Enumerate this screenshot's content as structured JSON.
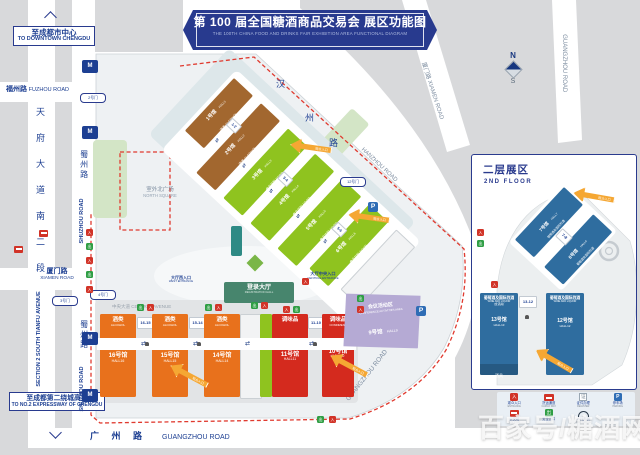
{
  "banner": {
    "zh": "第 100 届全国糖酒商品交易会 展区功能图",
    "en": "THE 100TH CHINA FOOD AND DRINKS FAIR  EXHIBITION AREA FUNCTIONAL DIAGRAM"
  },
  "signs": {
    "downtown_zh": "至成都市中心",
    "downtown_en": "TO DOWNTOWN CHENGDU",
    "expressway_zh": "至成都第二绕城高速",
    "expressway_en": "TO NO.2 EXPRESSWAY OF CHENGDU"
  },
  "roads": {
    "fuzhou_zh": "福州路",
    "fuzhou_en": "FUZHOU ROAD",
    "tianfu_chars": [
      "天",
      "府",
      "大",
      "道",
      "南",
      "二",
      "段"
    ],
    "tianfu_en": "SECTION 2 SOUTH TIANFU AVENUE",
    "shuzhou_zh": "蜀州路",
    "shuzhou_en": "SHUZHOU ROAD",
    "xiamen_zh": "厦门路",
    "xiamen_en": "XIAMEN ROAD",
    "hanzhou_chars": [
      "汉",
      "州",
      "路"
    ],
    "hanzhou_en": "HANZHOU ROAD",
    "guangzhou_zh": "广 州 路",
    "guangzhou_en": "GUANGZHOU ROAD",
    "central_avenue": "中央大道 CENTRAL AVENUE"
  },
  "places": {
    "north_square_zh": "室外北广场",
    "north_square_en": "NORTH SQUARE",
    "registration_zh": "登录大厅",
    "registration_en": "REGISTRATION HALL",
    "central_entrance_zh": "大厅中央入口",
    "central_entrance_en": "CENTRAL ENTRANCE",
    "west_entrance_zh": "大厅西入口",
    "west_entrance_en": "WEST ENTRANCE"
  },
  "gates": [
    "2号门",
    "3号门",
    "4号门",
    "12号门"
  ],
  "arrow_label": "观众入口",
  "compass": {
    "n": "N",
    "s": "S"
  },
  "halls_upper": [
    {
      "zh": "1号馆",
      "en": "HALL1",
      "cat": "酒类 ALCOHOL"
    },
    {
      "zh": "2号馆",
      "en": "HALL2",
      "cat": "酒类 ALCOHOL"
    },
    {
      "zh": "3号馆",
      "en": "HALL3",
      "cat": "食品饮料 FOOD"
    },
    {
      "zh": "4号馆",
      "en": "HALL4",
      "cat": "食品饮料 FOOD"
    },
    {
      "zh": "5号馆",
      "en": "HALL5",
      "cat": "食品饮料 FOOD"
    },
    {
      "zh": "6号馆",
      "en": "HALL6",
      "cat": "食品饮料 FOOD"
    }
  ],
  "upper_connectors": [
    "1-2",
    "3-4",
    "5-6"
  ],
  "halls_lower": {
    "h16": {
      "zh": "16号馆",
      "en": "HALL16",
      "cat_zh": "酒类",
      "cat_en": "ALCOHOL"
    },
    "h15": {
      "zh": "15号馆",
      "en": "HALL15",
      "cat_zh": "酒类",
      "cat_en": "ALCOHOL"
    },
    "h14": {
      "zh": "14号馆",
      "en": "HALL14",
      "cat_zh": "酒类",
      "cat_en": "ALCOHOL"
    },
    "h11": {
      "zh": "11号馆",
      "en": "HALL11",
      "cat_zh": "调味品",
      "cat_en": ""
    },
    "h10": {
      "zh": "10号馆",
      "en": "HALL10",
      "cat_zh": "调味品",
      "cat_en": "CONDIMENT"
    },
    "conn_16_15": "16-15",
    "conn_15_14": "15-14",
    "conn_11_10": "11-10"
  },
  "hall9": {
    "zone_zh": "会议活动区",
    "zone_en": "CONFERENCE ACTIVITIES AREA",
    "zh": "9号馆",
    "en": "HALL9"
  },
  "floor2": {
    "title_zh": "二层展区",
    "title_en": "2ND FLOOR",
    "h7": {
      "zh": "7号馆",
      "en": "HALL7",
      "cat": "葡萄酒及国际烈酒"
    },
    "h8": {
      "zh": "8号馆",
      "en": "HALL8",
      "cat": "葡萄酒及国际烈酒"
    },
    "conn_7_8": "7-8",
    "h13": {
      "zh": "13号馆",
      "en": "HALL13",
      "cat_zh": "葡萄酒及国际烈酒",
      "cat_en": "WINE AND LIQUOR",
      "note": "(含酒具)",
      "sub": "酒具"
    },
    "h12": {
      "zh": "12号馆",
      "en": "HALL12",
      "cat_zh": "葡萄酒及国际烈酒",
      "cat_en": "WINE AND LIQUOR"
    },
    "conn_13_12": "13-12"
  },
  "legend": [
    {
      "zh": "观众入口",
      "en": "ENTRANCE"
    },
    {
      "zh": "货运通道",
      "en": "CARGO WAY"
    },
    {
      "zh": "证件办理",
      "en": "REGISTER"
    },
    {
      "zh": "停车场",
      "en": "PARKING"
    },
    {
      "zh": "公交站",
      "en": "BUS STOP"
    },
    {
      "zh": "安全出口",
      "en": "EXIT"
    },
    {
      "zh": "人行天桥",
      "en": "FOOTBRIDGE"
    }
  ],
  "watermark": "百家号/糖酒网",
  "colors": {
    "navy": "#283a8e",
    "brown": "#a2672f",
    "green": "#8fc31f",
    "orange": "#e8711c",
    "red": "#d42a1e",
    "blue2f": "#2f6d9f",
    "purple": "#b5aad4",
    "arrow": "#f5a733",
    "teal": "#3f8570"
  }
}
